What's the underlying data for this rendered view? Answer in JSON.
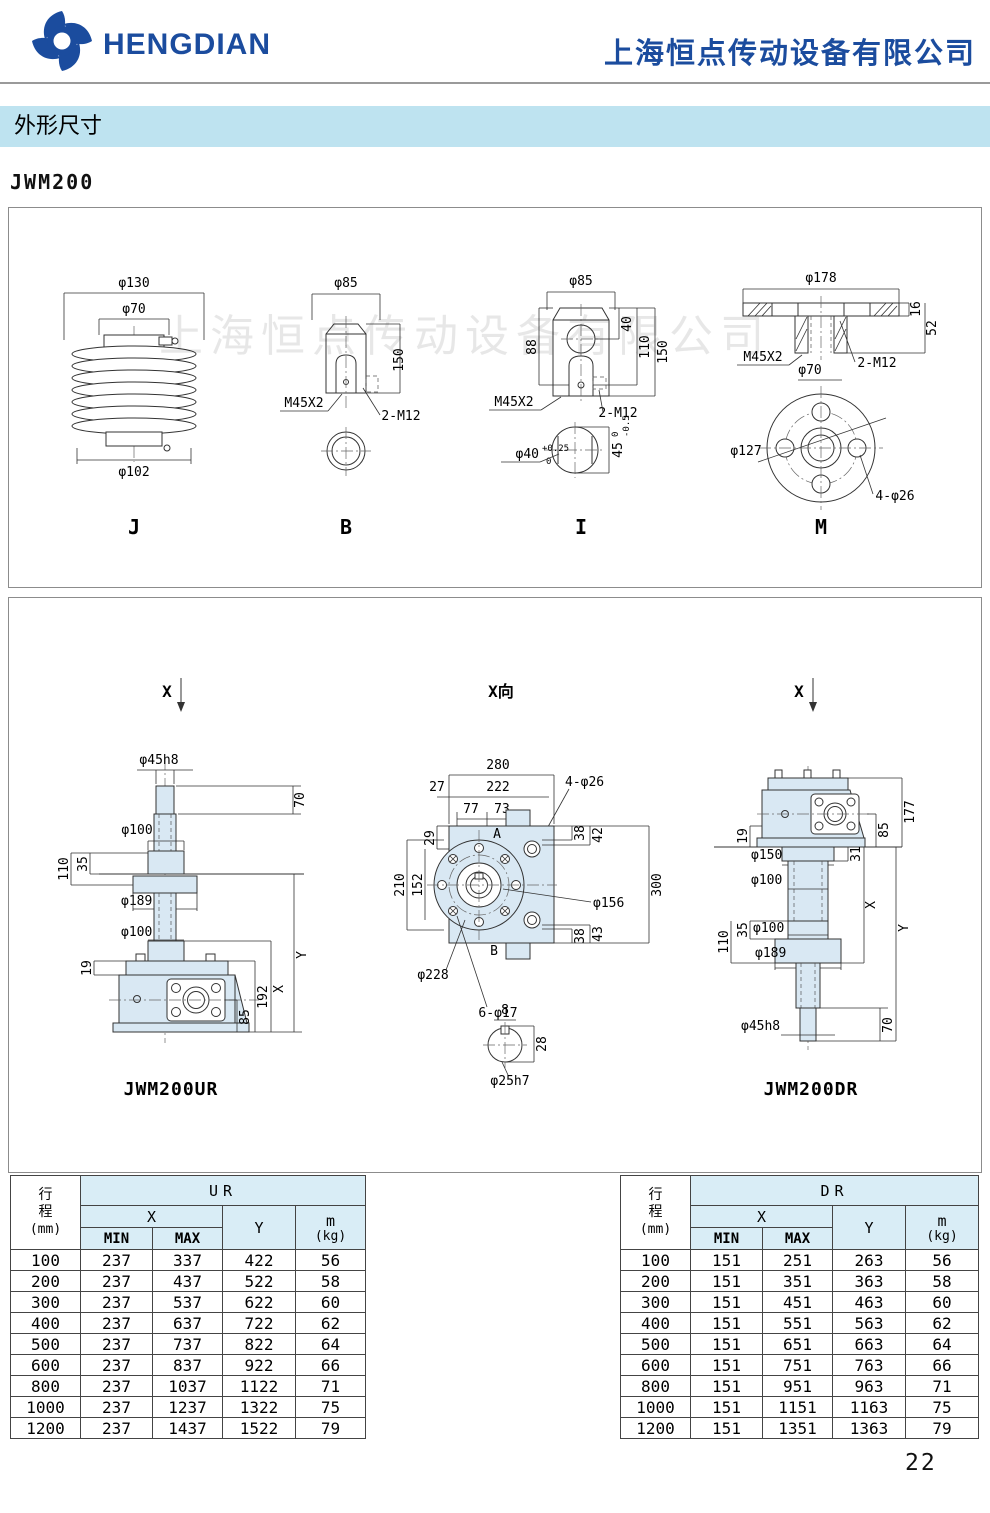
{
  "header": {
    "brand": "HENGDIAN",
    "company": "上海恒点传动设备有限公司"
  },
  "banner": {
    "title": "外形尺寸"
  },
  "model_label": "JWM200",
  "watermark": "上海恒点传动设备有限公司",
  "page_number": "22",
  "fig_j": {
    "caption": "J",
    "d130": "φ130",
    "d70": "φ70",
    "d102": "φ102"
  },
  "fig_b": {
    "caption": "B",
    "d85": "φ85",
    "h150": "150",
    "thread": "M45X2",
    "tap": "2-M12"
  },
  "fig_i": {
    "caption": "I",
    "d85": "φ85",
    "h88": "88",
    "h40": "40",
    "h110": "110",
    "h150": "150",
    "thread": "M45X2",
    "tap": "2-M12",
    "d40": "φ40",
    "d40_sup": "+0.25",
    "d40_sub": "0",
    "w45": "45",
    "w45_sup": "0",
    "w45_sub": "-0.5"
  },
  "fig_m": {
    "caption": "M",
    "d178": "φ178",
    "h16": "16",
    "h52": "52",
    "thread": "M45X2",
    "d70": "φ70",
    "tap": "2-M12",
    "d127": "φ127",
    "holes": "4-φ26"
  },
  "fig_ur": {
    "view": "X",
    "caption": "JWM200UR",
    "d45": "φ45h8",
    "h70": "70",
    "d100a": "φ100",
    "h110": "110",
    "h35": "35",
    "d189": "φ189",
    "d100b": "φ100",
    "dimy": "Y",
    "dimx": "X",
    "h192": "192",
    "h85": "85",
    "h19": "19"
  },
  "fig_xv": {
    "title": "X向",
    "w280": "280",
    "w222": "222",
    "w27": "27",
    "w77": "77",
    "w73": "73",
    "holes4": "4-φ26",
    "h29": "29",
    "h210": "210",
    "h152": "152",
    "pa": "A",
    "pb": "B",
    "h38a": "38",
    "h42": "42",
    "h38b": "38",
    "h43": "43",
    "h300": "300",
    "d156": "φ156",
    "d228": "φ228",
    "holes6": "6-φ17",
    "w8": "8",
    "h28": "28",
    "d25": "φ25h7"
  },
  "fig_dr": {
    "view": "X",
    "caption": "JWM200DR",
    "h19": "19",
    "h177": "177",
    "h85": "85",
    "d150": "φ150",
    "h31": "31",
    "d100a": "φ100",
    "dimx": "X",
    "dimy": "Y",
    "h110": "110",
    "h35": "35",
    "d100b": "φ100",
    "d189": "φ189",
    "h70": "70",
    "d45": "φ45h8"
  },
  "table_ur": {
    "stroke_l1": "行",
    "stroke_l2": "程",
    "unit": "(mm)",
    "group": "UR",
    "x": "X",
    "min": "MIN",
    "max": "MAX",
    "y": "Y",
    "m": "m",
    "mkg": "(kg)",
    "rows": [
      [
        "100",
        "237",
        "337",
        "422",
        "56"
      ],
      [
        "200",
        "237",
        "437",
        "522",
        "58"
      ],
      [
        "300",
        "237",
        "537",
        "622",
        "60"
      ],
      [
        "400",
        "237",
        "637",
        "722",
        "62"
      ],
      [
        "500",
        "237",
        "737",
        "822",
        "64"
      ],
      [
        "600",
        "237",
        "837",
        "922",
        "66"
      ],
      [
        "800",
        "237",
        "1037",
        "1122",
        "71"
      ],
      [
        "1000",
        "237",
        "1237",
        "1322",
        "75"
      ],
      [
        "1200",
        "237",
        "1437",
        "1522",
        "79"
      ]
    ]
  },
  "table_dr": {
    "stroke_l1": "行",
    "stroke_l2": "程",
    "unit": "(mm)",
    "group": "DR",
    "x": "X",
    "min": "MIN",
    "max": "MAX",
    "y": "Y",
    "m": "m",
    "mkg": "(kg)",
    "rows": [
      [
        "100",
        "151",
        "251",
        "263",
        "56"
      ],
      [
        "200",
        "151",
        "351",
        "363",
        "58"
      ],
      [
        "300",
        "151",
        "451",
        "463",
        "60"
      ],
      [
        "400",
        "151",
        "551",
        "563",
        "62"
      ],
      [
        "500",
        "151",
        "651",
        "663",
        "64"
      ],
      [
        "600",
        "151",
        "751",
        "763",
        "66"
      ],
      [
        "800",
        "151",
        "951",
        "963",
        "71"
      ],
      [
        "1000",
        "151",
        "1151",
        "1163",
        "75"
      ],
      [
        "1200",
        "151",
        "1351",
        "1363",
        "79"
      ]
    ]
  }
}
